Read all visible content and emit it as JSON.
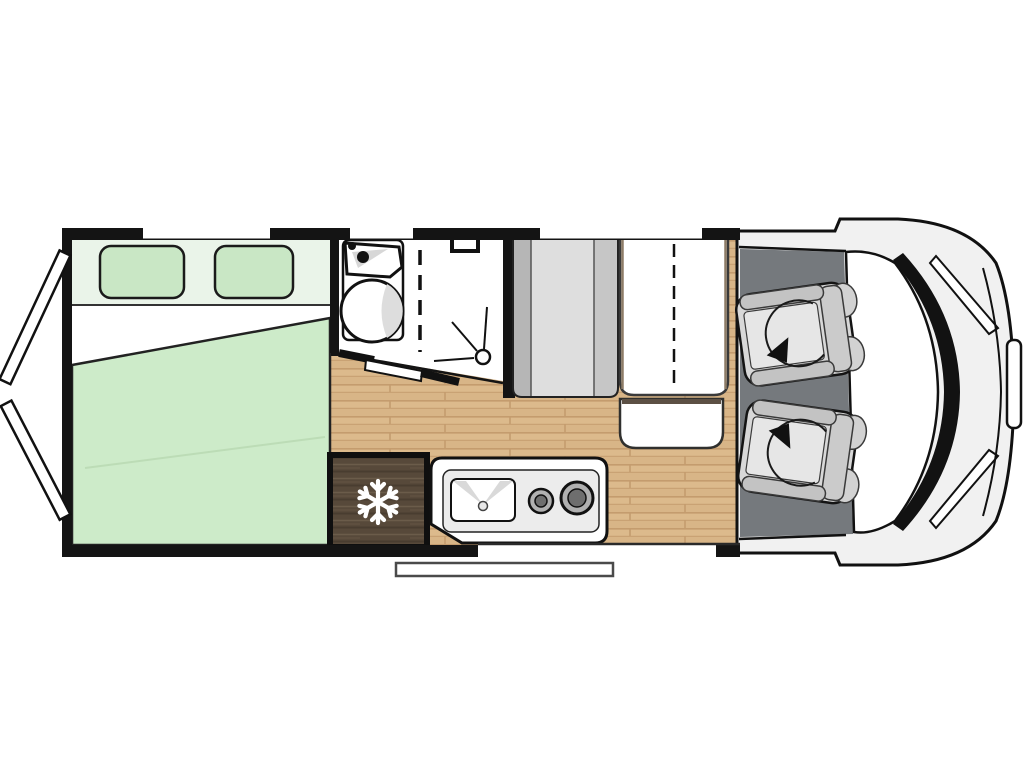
{
  "diagram": {
    "type": "motorhome-floorplan-top-view",
    "orientation": "cab-right-rear-left"
  },
  "palette": {
    "wall": "#141414",
    "wood_floor": "#dcba8c",
    "wood_floor_band": "#d4b183",
    "wood_floor_line": "#c49c6e",
    "cab_floor": "#75797d",
    "bed_duvet": "#cdebc9",
    "bed_headboard": "#eaf4e9",
    "bed_pillow": "#c9e7c5",
    "bed_sheet": "#ffffff",
    "fridge_wood": "#57493a",
    "fridge_wood_light": "#6b5c4a",
    "fridge_wood_dark": "#493d30",
    "van_body": "#f1f1f1",
    "seat_shell": "#d8d8d8",
    "seat_bolster": "#c3c3c3",
    "seat_cushion": "#e6e6e6",
    "bench_dark": "#b6b6b6",
    "bench_light": "#dedede",
    "bench_mid": "#c6c6c6",
    "table_trim": "#8d7c67",
    "bench_shadow": "#5c5044",
    "fixture_white": "#ffffff",
    "fixture_shade": "#d9d9d9",
    "burner_ring": "#b0b0b0",
    "burner_center": "#6e6e6e"
  },
  "zones": {
    "bed": "rear-double-bed",
    "bathroom": "washroom-with-shower",
    "kitchen": "kitchenette-sink-and-hob",
    "fridge": "refrigerator",
    "dinette": "side-bench-and-table",
    "cab": "driver-cab-swivel-seats",
    "entry": "entry-step",
    "rear": "rear-doors-open"
  },
  "icons": {
    "fridge": "snowflake-icon",
    "seats": "swivel-arrow-icon",
    "shower": "drain-icon",
    "sink": "faucet-dots-icon"
  }
}
